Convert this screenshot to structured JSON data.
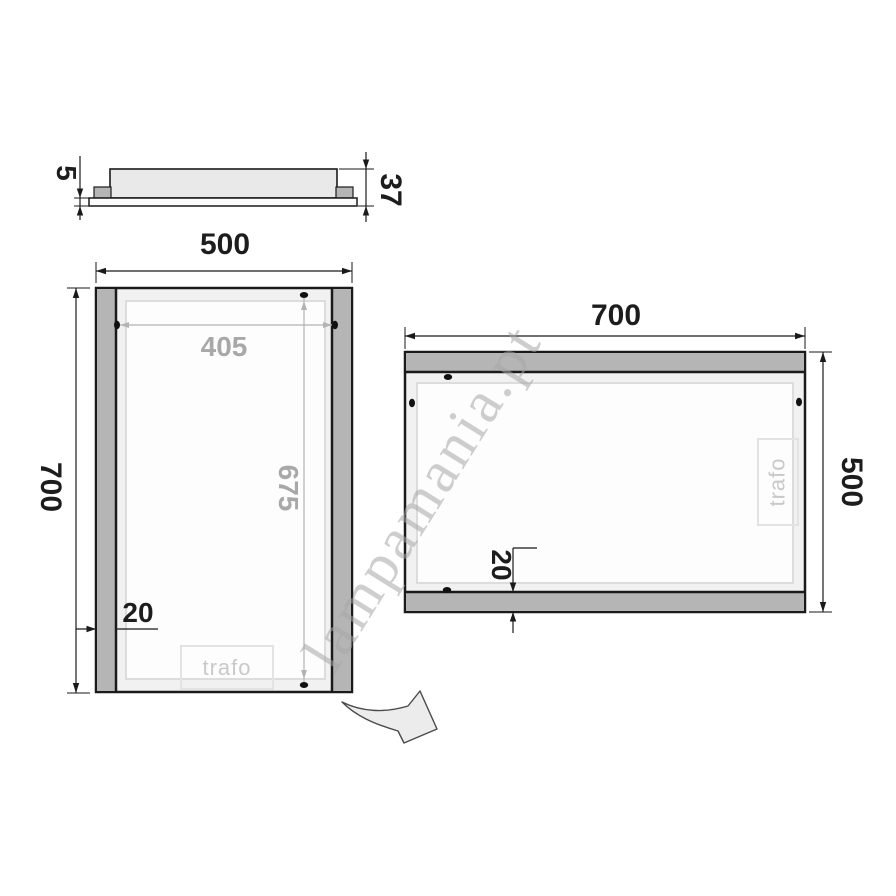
{
  "watermark": "lampamania.pt",
  "views": {
    "profile": {
      "name": "side profile view",
      "dims": {
        "glass_thickness": "5",
        "depth": "37"
      }
    },
    "portrait": {
      "name": "front view portrait 500x700",
      "dims": {
        "width": "500",
        "height": "700",
        "inner_width": "405",
        "inner_height": "675",
        "frame": "20"
      },
      "trafo": "trafo"
    },
    "landscape": {
      "name": "front view rotated 700x500",
      "dims": {
        "width": "700",
        "height": "500",
        "frame": "20"
      },
      "trafo": "trafo"
    }
  },
  "colors": {
    "line": "#1a1a1a",
    "frame_gray": "#b5b5b5",
    "fill_light": "#e9e9e9",
    "dim_gray": "#a8a8a8",
    "inner_border": "#dcdcdc",
    "watermark_gray": "#c6c6c6"
  }
}
